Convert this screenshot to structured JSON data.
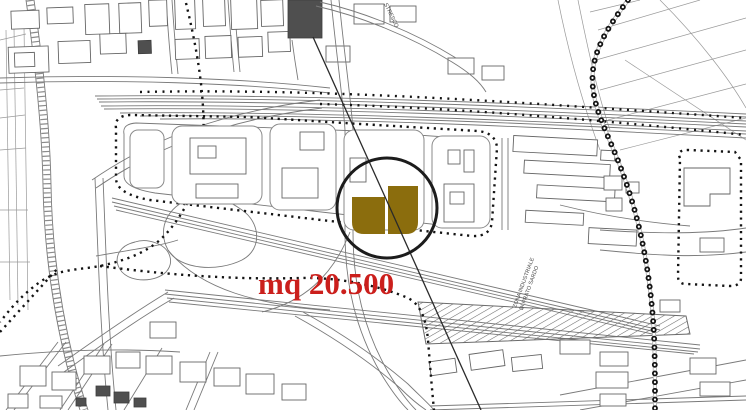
{
  "map": {
    "background": "#ffffff",
    "linework_color": "#7a7a7a",
    "boundary_color": "#141414",
    "annotation": {
      "area_label": "mq 20.500",
      "label_color": "#cb1f1c",
      "circle_color": "#1c1c1c",
      "parcel_fill": "#8b6d0d"
    },
    "labels": {
      "zone_label_line1": "ZONA INDUSTRIALE",
      "zone_label_line2": "DI PRATO SARDO",
      "street_label": "STRESCO"
    }
  }
}
